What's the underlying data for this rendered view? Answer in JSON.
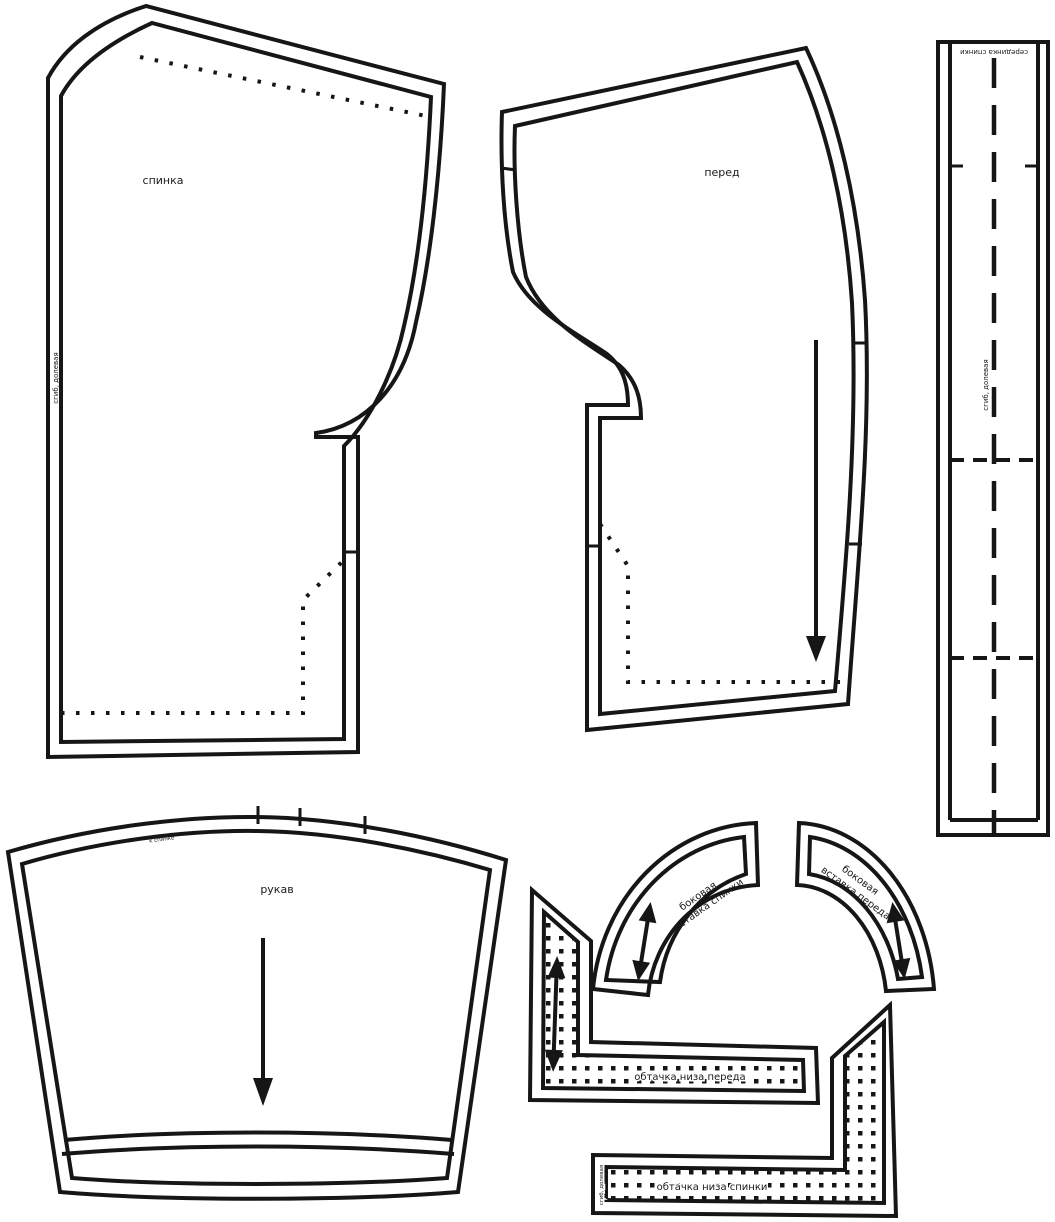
{
  "document": {
    "type": "sewing-pattern-sheet",
    "background_color": "#ffffff",
    "line_color": "#161616"
  },
  "pieces": {
    "back": {
      "label": "спинка",
      "fold_label": "сгиб, долевая"
    },
    "front": {
      "label": "перед"
    },
    "center_strip": {
      "top_label": "серединка спинки",
      "fold_label": "сгиб, долевая"
    },
    "sleeve": {
      "label": "рукав",
      "notch_label": "к спинке"
    },
    "side_insert_back": {
      "label_line1": "боковая",
      "label_line2": "вставка спинки"
    },
    "side_insert_front": {
      "label_line1": "боковая",
      "label_line2": "вставка переда"
    },
    "front_hem_facing": {
      "label": "обтачка низа переда"
    },
    "back_hem_facing": {
      "label": "обтачка низа спинки",
      "fold_label": "сгиб, долевая"
    }
  }
}
